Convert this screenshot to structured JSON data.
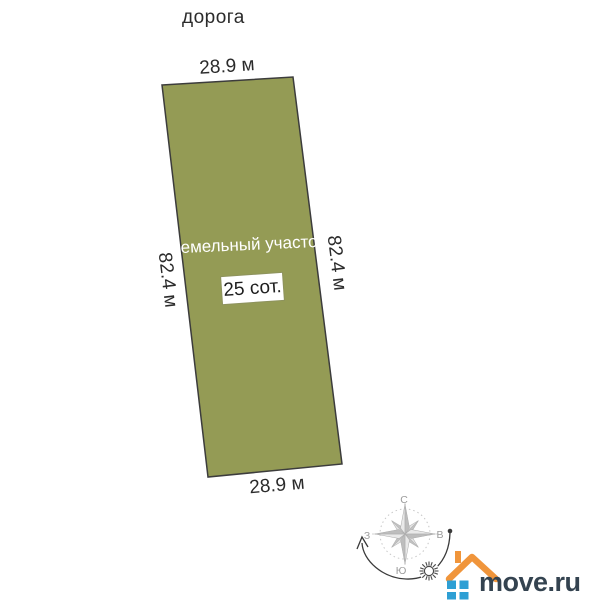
{
  "diagram": {
    "road_label": "дорога",
    "plot": {
      "label": "земельный участок",
      "area_label": "25 сот.",
      "width_top": "28.9 м",
      "width_bottom": "28.9 м",
      "length_left": "82.4 м",
      "length_right": "82.4 м",
      "fill_color": "#949B55",
      "border_color": "#3C3C3C"
    },
    "compass": {
      "north_label": "С",
      "south_label": "Ю",
      "west_label": "З",
      "east_label": "В"
    }
  },
  "branding": {
    "logo_text": "move.ru",
    "roof_color": "#F0953B",
    "window_color": "#2E9FD4",
    "text_color": "#344350"
  }
}
